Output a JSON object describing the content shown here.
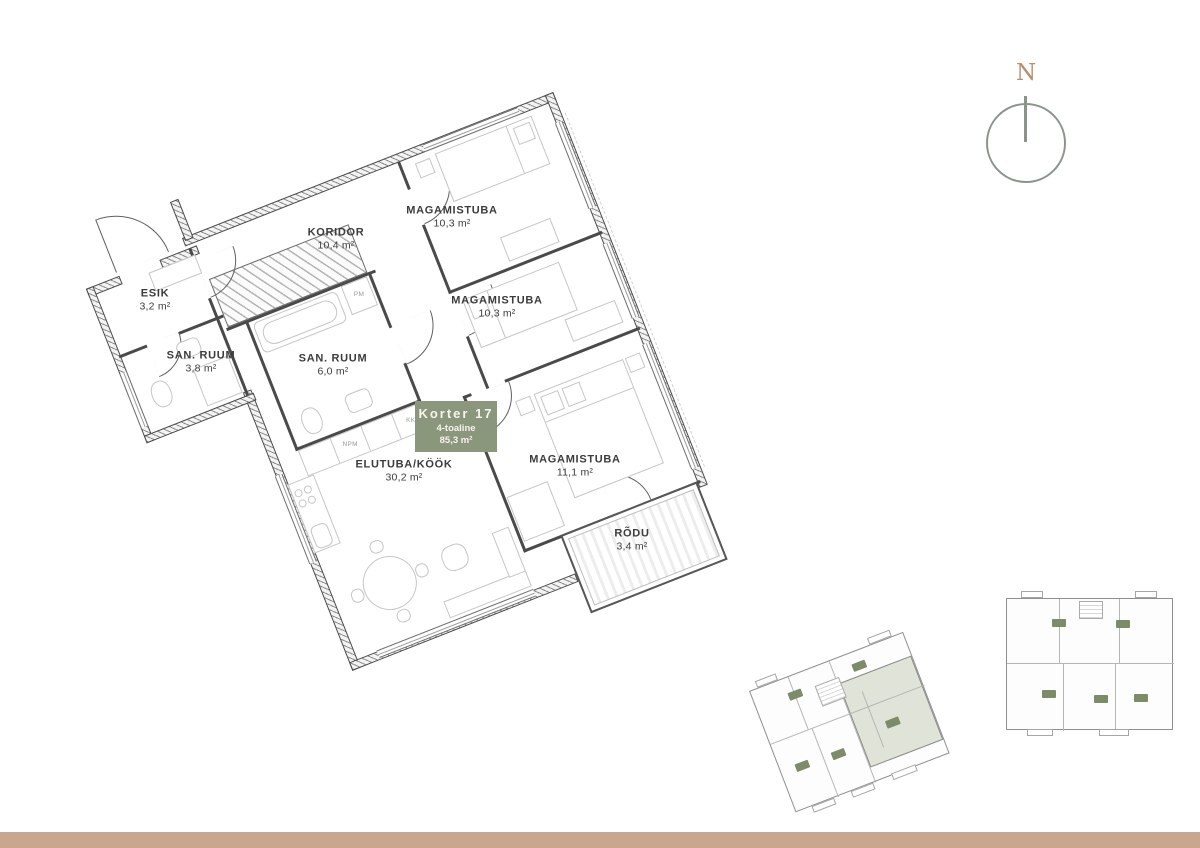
{
  "page": {
    "background": "#ffffff",
    "footer_bar_color": "#c8a78e"
  },
  "compass": {
    "label": "N",
    "ring_color": "#8b948b",
    "letter_color": "#b58f6e"
  },
  "unit_card": {
    "title": "Korter 17",
    "subtitle": "4-toaline",
    "area": "85,3 m²",
    "bg_color": "#8b977d",
    "text_color": "#f7f4ec"
  },
  "floor_plan": {
    "rotation_deg": -21.5,
    "wall_color": "#4a4a4a",
    "furniture_color": "#c6c6c6",
    "rooms": [
      {
        "name": "ESIK",
        "area": "3,2 m²"
      },
      {
        "name": "SAN. RUUM",
        "area": "3,8 m²"
      },
      {
        "name": "KORIDOR",
        "area": "10,4 m²"
      },
      {
        "name": "SAN. RUUM",
        "area": "6,0 m²"
      },
      {
        "name": "MAGAMISTUBA",
        "area": "10,3 m²"
      },
      {
        "name": "MAGAMISTUBA",
        "area": "10,3 m²"
      },
      {
        "name": "MAGAMISTUBA",
        "area": "11,1 m²"
      },
      {
        "name": "ELUTUBA/KÖÖK",
        "area": "30,2 m²"
      },
      {
        "name": "RÕDU",
        "area": "3,4 m²"
      }
    ],
    "appliances": {
      "pm": "PM",
      "npm": "NPM",
      "kk": "KK"
    }
  },
  "mini_plans": {
    "highlight_fill": "#dfe3d8",
    "unit_badge_color": "#7d8b68",
    "outline_color": "#8f8f8f"
  }
}
